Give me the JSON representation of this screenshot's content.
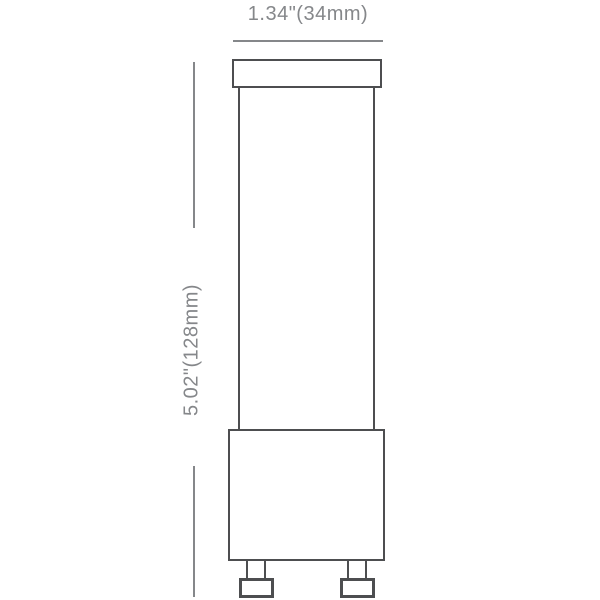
{
  "diagram": {
    "type": "technical-dimension-drawing",
    "subject": "tubular lamp with cap, base and two bottom pins",
    "width_dimension": {
      "label": "1.34\"(34mm)",
      "inches": 1.34,
      "millimeters": 34
    },
    "height_dimension": {
      "label": "5.02\"(128mm)",
      "inches": 5.02,
      "millimeters": 128
    },
    "colors": {
      "outline": "#4d4e50",
      "dimension": "#85878a",
      "background": "#ffffff"
    }
  }
}
